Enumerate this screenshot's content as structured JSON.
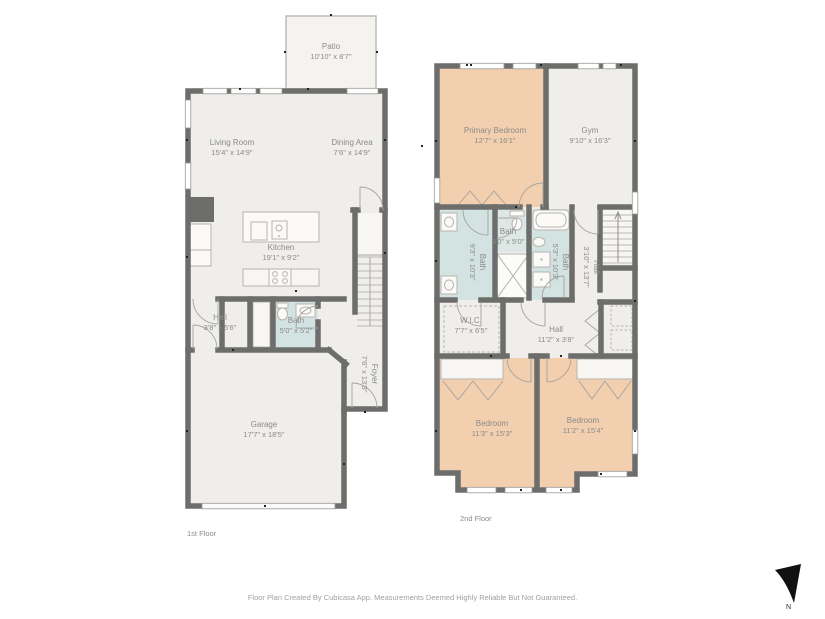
{
  "document": {
    "type": "floor-plan",
    "footer_disclaimer": "Floor Plan Created By Cubicasa App. Measurements Deemed Highly Reliable But Not Guaranteed.",
    "compass_label": "N"
  },
  "colors": {
    "wall": "#6d6d6b",
    "room_fill": "#efeeea",
    "patio_fill": "#f4f3ef",
    "bedroom_fill": "#f2cfae",
    "bath_fill": "#d3e3e2",
    "label_text": "#8b8b89",
    "footer_text": "#a2a19f"
  },
  "floor1": {
    "label": "1st Floor",
    "rooms": {
      "patio": {
        "name": "Patio",
        "dims": "10'10\" x 8'7\""
      },
      "living_room": {
        "name": "Living Room",
        "dims": "15'4\" x 14'9\""
      },
      "dining_area": {
        "name": "Dining Area",
        "dims": "7'6\" x 14'9\""
      },
      "kitchen": {
        "name": "Kitchen",
        "dims": "19'1\" x 9'2\""
      },
      "hall": {
        "name": "Hall",
        "dims": "3'8\" x 5'6\""
      },
      "bath": {
        "name": "Bath",
        "dims": "5'0\" x 5'2\""
      },
      "foyer": {
        "name": "Foyer",
        "dims": "7'6\" x 13'3\""
      },
      "garage": {
        "name": "Garage",
        "dims": "17'7\" x 18'5\""
      }
    }
  },
  "floor2": {
    "label": "2nd Floor",
    "rooms": {
      "primary_bedroom": {
        "name": "Primary Bedroom",
        "dims": "12'7\" x 16'1\""
      },
      "gym": {
        "name": "Gym",
        "dims": "9'10\" x 16'3\""
      },
      "bath_small": {
        "name": "Bath",
        "dims": "3'0\" x 5'0\""
      },
      "bath_left": {
        "name": "Bath",
        "dims": "9'3\" x 10'3\""
      },
      "bath_right": {
        "name": "Bath",
        "dims": "5'3\" x 10'3\""
      },
      "hall_upper": {
        "name": "Hall",
        "dims": "3'10\" x 13'7\""
      },
      "wic": {
        "name": "W.I.C.",
        "dims": "7'7\" x 6'5\""
      },
      "hall_lower": {
        "name": "Hall",
        "dims": "11'2\" x 3'8\""
      },
      "bedroom_left": {
        "name": "Bedroom",
        "dims": "11'3\" x 15'3\""
      },
      "bedroom_right": {
        "name": "Bedroom",
        "dims": "11'2\" x 15'4\""
      }
    }
  }
}
